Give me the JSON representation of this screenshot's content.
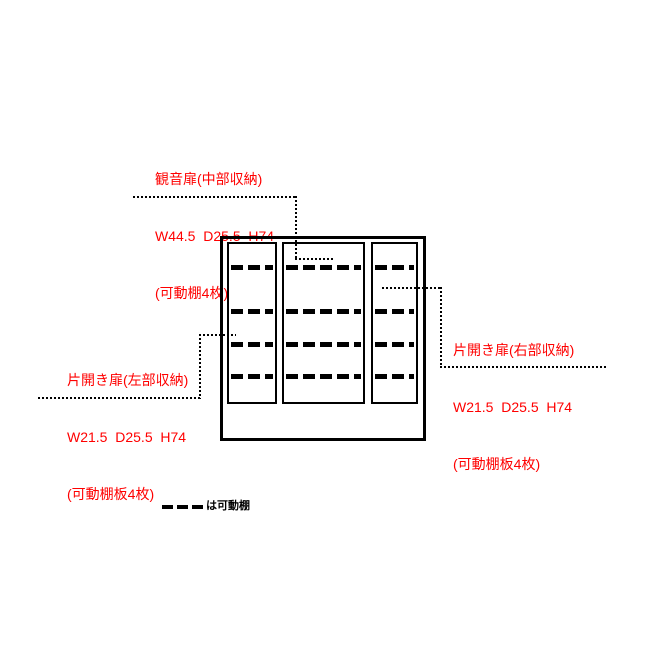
{
  "figure": {
    "background_color": "#ffffff",
    "line_color": "#000000",
    "annotation_color": "#ff0000"
  },
  "labels": {
    "middle": {
      "line1": "観音扉(中部収納)",
      "line2": "W44.5  D25.5  H74",
      "line3": "(可動棚4枚)"
    },
    "left": {
      "line1": "片開き扉(左部収納)",
      "line2": "W21.5  D25.5  H74",
      "line3": "(可動棚板4枚)"
    },
    "right": {
      "line1": "片開き扉(右部収納)",
      "line2": "W21.5  D25.5  H74",
      "line3": "(可動棚板4枚)"
    }
  },
  "cabinet": {
    "sections": [
      {
        "id": "left",
        "shelf_rows": 4
      },
      {
        "id": "middle",
        "shelf_rows": 4
      },
      {
        "id": "right",
        "shelf_rows": 4
      }
    ]
  },
  "legend": {
    "label": "は可動棚"
  }
}
